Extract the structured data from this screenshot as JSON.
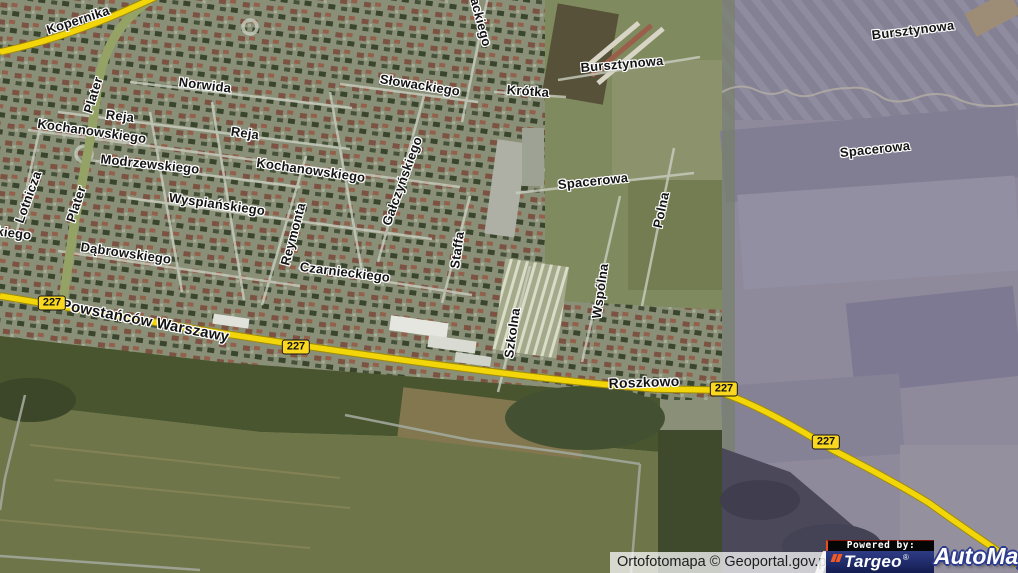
{
  "map": {
    "street_labels": [
      {
        "text": "Kopernika",
        "x": 78,
        "y": 20,
        "rot": -18
      },
      {
        "text": "Norwida",
        "x": 205,
        "y": 85,
        "rot": 7
      },
      {
        "text": "Reja",
        "x": 120,
        "y": 116,
        "rot": 7
      },
      {
        "text": "Kochanowskiego",
        "x": 92,
        "y": 131,
        "rot": 8
      },
      {
        "text": "Reja",
        "x": 245,
        "y": 133,
        "rot": 8
      },
      {
        "text": "Kochanowskiego",
        "x": 311,
        "y": 170,
        "rot": 8
      },
      {
        "text": "Modrzewskiego",
        "x": 150,
        "y": 164,
        "rot": 6
      },
      {
        "text": "Wyspiańskiego",
        "x": 217,
        "y": 204,
        "rot": 8
      },
      {
        "text": "Dąbrowskiego",
        "x": 126,
        "y": 253,
        "rot": 8
      },
      {
        "text": "Czarnieckiego",
        "x": 345,
        "y": 272,
        "rot": 7
      },
      {
        "text": "Słowackiego",
        "x": 420,
        "y": 85,
        "rot": 9
      },
      {
        "text": "Krótka",
        "x": 528,
        "y": 91,
        "rot": 4
      },
      {
        "text": "Bursztynowa",
        "x": 622,
        "y": 64,
        "rot": -5
      },
      {
        "text": "Spacerowa",
        "x": 593,
        "y": 181,
        "rot": -6
      },
      {
        "text": "Bursztynowa",
        "x": 913,
        "y": 30,
        "rot": -7
      },
      {
        "text": "Spacerowa",
        "x": 875,
        "y": 149,
        "rot": -6
      },
      {
        "text": "kiego",
        "x": 14,
        "y": 233,
        "rot": 7
      },
      {
        "text": "ackiego",
        "x": 481,
        "y": 22,
        "rot": 75
      },
      {
        "text": "Lotnicza",
        "x": 28,
        "y": 197,
        "rot": -70
      },
      {
        "text": "Plater",
        "x": 93,
        "y": 95,
        "rot": -73
      },
      {
        "text": "Plater",
        "x": 76,
        "y": 204,
        "rot": -72
      },
      {
        "text": "Reymonta",
        "x": 293,
        "y": 234,
        "rot": -75
      },
      {
        "text": "Gałczyńskiego",
        "x": 402,
        "y": 181,
        "rot": -70
      },
      {
        "text": "Staffa",
        "x": 457,
        "y": 250,
        "rot": -82
      },
      {
        "text": "Szkolna",
        "x": 512,
        "y": 333,
        "rot": -82
      },
      {
        "text": "Wspólna",
        "x": 600,
        "y": 291,
        "rot": -82
      },
      {
        "text": "Polna",
        "x": 661,
        "y": 210,
        "rot": -78
      }
    ],
    "road_labels": [
      {
        "text": "Powstańców Warszawy",
        "x": 145,
        "y": 321,
        "rot": 11,
        "fs": 15
      },
      {
        "text": "Roszkowo",
        "x": 644,
        "y": 382,
        "rot": -2,
        "fs": 14
      }
    ],
    "road_badges": [
      {
        "text": "227",
        "x": 52,
        "y": 303
      },
      {
        "text": "227",
        "x": 296,
        "y": 347
      },
      {
        "text": "227",
        "x": 724,
        "y": 389
      },
      {
        "text": "227",
        "x": 826,
        "y": 442
      }
    ],
    "road_number": "227"
  },
  "footer": {
    "attribution": "Ortofotomapa © Geoportal.gov.pl",
    "powered_by": "Powered by:",
    "targeo_logo": "Targeo",
    "automapa_logo": "AutoMapa",
    "registered_mark": "®"
  },
  "colors": {
    "road_yellow": "#f2d60a",
    "road_casing": "#a08b08",
    "badge_yellow": "#fbd820",
    "label_text": "#141414",
    "label_halo": "#ffffff",
    "targeo_navy": "#1b2766",
    "targeo_orange": "#f15a24",
    "automapa_outline": "#2e3c8e",
    "right_tile_tint": "#8e8a9b",
    "urban_base": "#8a9077",
    "forest_green": "#49552f",
    "field_green": "#6e7549"
  }
}
